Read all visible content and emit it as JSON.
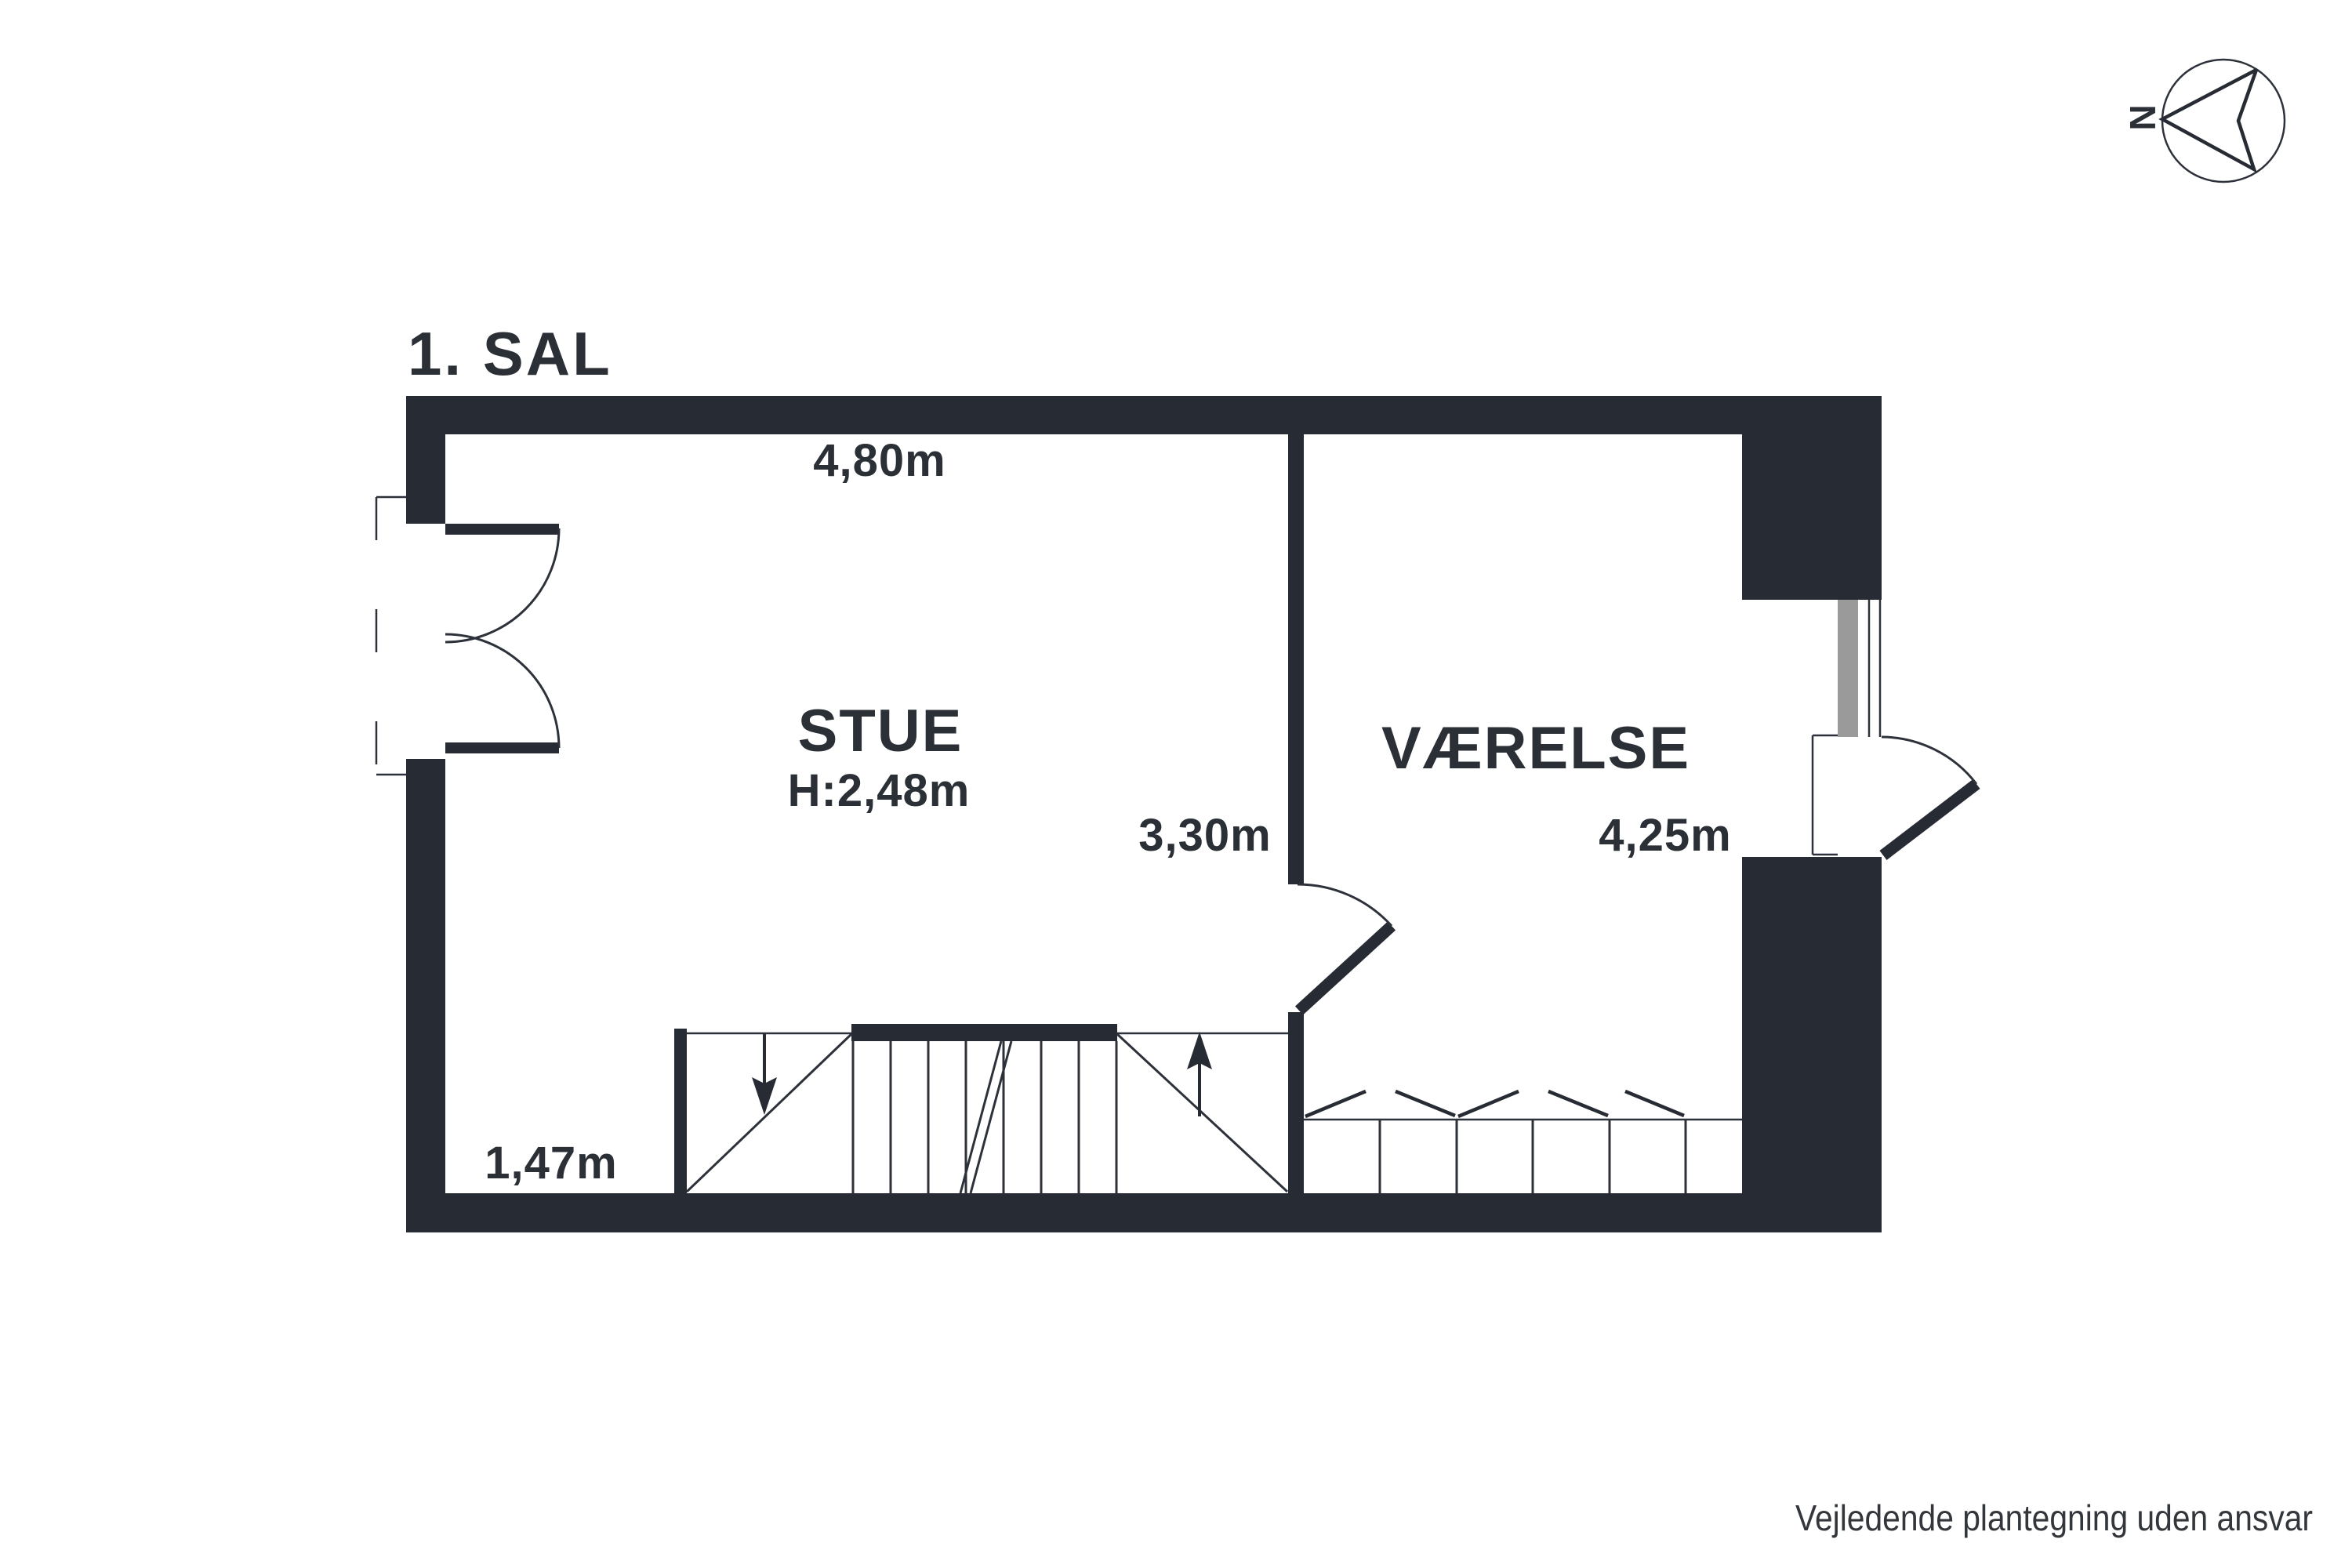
{
  "title": "1. SAL",
  "compass": {
    "label": "N"
  },
  "plan": {
    "rooms": [
      {
        "name": "STUE",
        "ceiling_height": "H:2,48m",
        "width": "4,80m",
        "depth": "3,30m"
      },
      {
        "name": "VÆRELSE",
        "width": "4,25m"
      }
    ],
    "stair_width": "1,47m",
    "features": [
      "staircase",
      "french-balcony-doors",
      "interior-door",
      "exterior-door",
      "window",
      "wardrobe"
    ]
  },
  "disclaimer": "Vejledende plantegning uden ansvar",
  "colors": {
    "wall": "#272b33",
    "text": "#2b2f36",
    "line": "#2c313a",
    "window_sash": "#9a9a9a",
    "disclaimer_text": "#33373c",
    "background": "#ffffff"
  }
}
